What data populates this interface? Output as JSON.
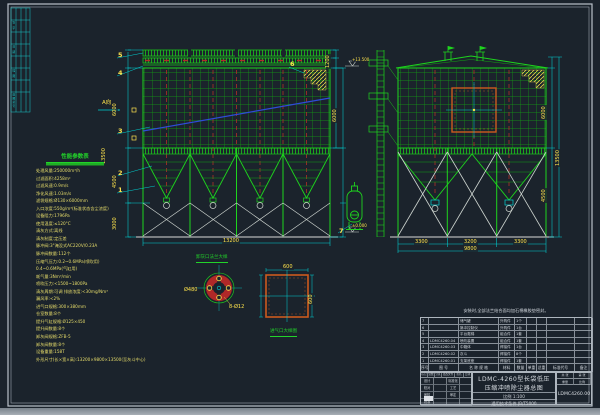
{
  "colors": {
    "background": "#1b232c",
    "line_green": "#1ed41e",
    "grid_green": "#12a312",
    "dim_cyan": "#00d2d2",
    "text_yellow": "#ffe44d",
    "bag_red": "#b03028",
    "door_orange": "#cc5a1e",
    "duct_blue": "#2f4bd8",
    "frame_white": "#b9c0c9"
  },
  "border_strip": {
    "labels": [
      "签 字",
      "日 期",
      "描 图",
      "底图总号"
    ]
  },
  "balloons": [
    "1",
    "2",
    "3",
    "4",
    "5",
    "6",
    "7"
  ],
  "view": {
    "a_direction": "A向"
  },
  "params": {
    "title": "性能参数表",
    "rows": [
      "处理风量:250000m³/h",
      "过滤面积:4258m²",
      "过滤风速:0.9m/s",
      "净化风速:1.03m/s",
      "滤袋规格:Ø130×6000mm",
      "入口浓度:550g/m³(标准状态含尘浓度)",
      "设备阻力:1796Pa",
      "使用温度:≤120°C",
      "清灰方式:离线",
      "清灰制度:定压差",
      "脉冲阀:3\"淹没式AC220V/0.23A",
      "脉冲阀数量:112个",
      "压缩气压力:0.2~0.6MPa(喷吹用)",
      "0.4~0.6MPa(气缸用)",
      "耗气量:3Nm³/min",
      "喷吹压力:<1500~1800Pa",
      "清灰周期:可调  排放浓度:<30mg/Nm³",
      "漏风率:<2%",
      "进气口规格:300×380mm",
      "仓室数量:8个",
      "提升气缸规格:Ø125×450",
      "提升阀数量:8个",
      "卸灰阀规格:ZFB-5",
      "卸灰阀数量:8个",
      "设备重量:158T",
      "外形尺寸(长×宽×高):13200×9800×13500(至灰斗中心)"
    ]
  },
  "dims": {
    "fv_total": "13200",
    "fv_h_casing": "6000",
    "fv_h_hopper": "4500",
    "fv_h_legs": "3000",
    "fv_h_total": "13500",
    "fv_roof": "1200",
    "fv_right": "6000",
    "elev_top": "+13.500",
    "elev_zero": "±0.000",
    "sv_s1": "3300",
    "sv_s2": "3200",
    "sv_s3": "3300",
    "sv_total": "9800",
    "sv_right_casing": "6000",
    "sv_right_hopper": "4500",
    "sv_h_total": "13500",
    "sq_top": "600",
    "sq_right": "600",
    "circle_dim1": "Ø480",
    "circle_dim2": "8-Ø12"
  },
  "details": {
    "circle_title": "卸灰口法兰大样",
    "square_title": "进气口大样图"
  },
  "bom": {
    "note": "安装时,全部法兰结合面均加石棉橡胶垫密封。",
    "headers": [
      "序号",
      "图  号",
      "名 称 规 格",
      "材料",
      "数量",
      "单重",
      "总重",
      "标准代号",
      "备注"
    ],
    "rows": [
      {
        "no": "7",
        "code": "",
        "name": "储气罐",
        "mat": "外购件",
        "qty": "1个",
        "w1": "",
        "w2": "",
        "std": "",
        "rem": ""
      },
      {
        "no": "6",
        "code": "",
        "name": "脉冲控制仪",
        "mat": "外购件",
        "qty": "1台",
        "w1": "",
        "w2": "",
        "std": "",
        "rem": ""
      },
      {
        "no": "5",
        "code": "",
        "name": "平台爬梯",
        "mat": "组合件",
        "qty": "1套",
        "w1": "",
        "w2": "",
        "std": "",
        "rem": ""
      },
      {
        "no": "4",
        "code": "LDMC4260.04",
        "name": "喷吹装置",
        "mat": "组合件",
        "qty": "1套",
        "w1": "",
        "w2": "",
        "std": "",
        "rem": ""
      },
      {
        "no": "3",
        "code": "LDMC4260.03",
        "name": "中箱体",
        "mat": "焊接件",
        "qty": "1台",
        "w1": "",
        "w2": "",
        "std": "",
        "rem": ""
      },
      {
        "no": "2",
        "code": "LDMC4260.02",
        "name": "灰斗",
        "mat": "焊接件",
        "qty": "8个",
        "w1": "",
        "w2": "",
        "std": "",
        "rem": ""
      },
      {
        "no": "1",
        "code": "LDMC4260.01",
        "name": "支架底座",
        "mat": "焊接件",
        "qty": "1套",
        "w1": "",
        "w2": "",
        "std": "",
        "rem": ""
      }
    ]
  },
  "title_block": {
    "title_line1": "LDMC-4260型长袋低压",
    "title_line2": "压缩冲喷除尘器总图",
    "scale_text": "比例 1:100",
    "std_text": "通用技术条件 JB/T5000",
    "drawing_no": "LDMC4260.00",
    "sig": {
      "r1": [
        "标记",
        "处数",
        "分区",
        "更改文件号",
        "签名",
        "日期"
      ],
      "left_labels": [
        "设计",
        "校对",
        "审核",
        "批准"
      ],
      "right_labels": [
        "标准化",
        "工艺",
        "审定",
        ""
      ]
    },
    "right_cells": {
      "c1": "共 张",
      "c2": "第 张",
      "c3": "重量",
      "c4": "比例"
    }
  }
}
